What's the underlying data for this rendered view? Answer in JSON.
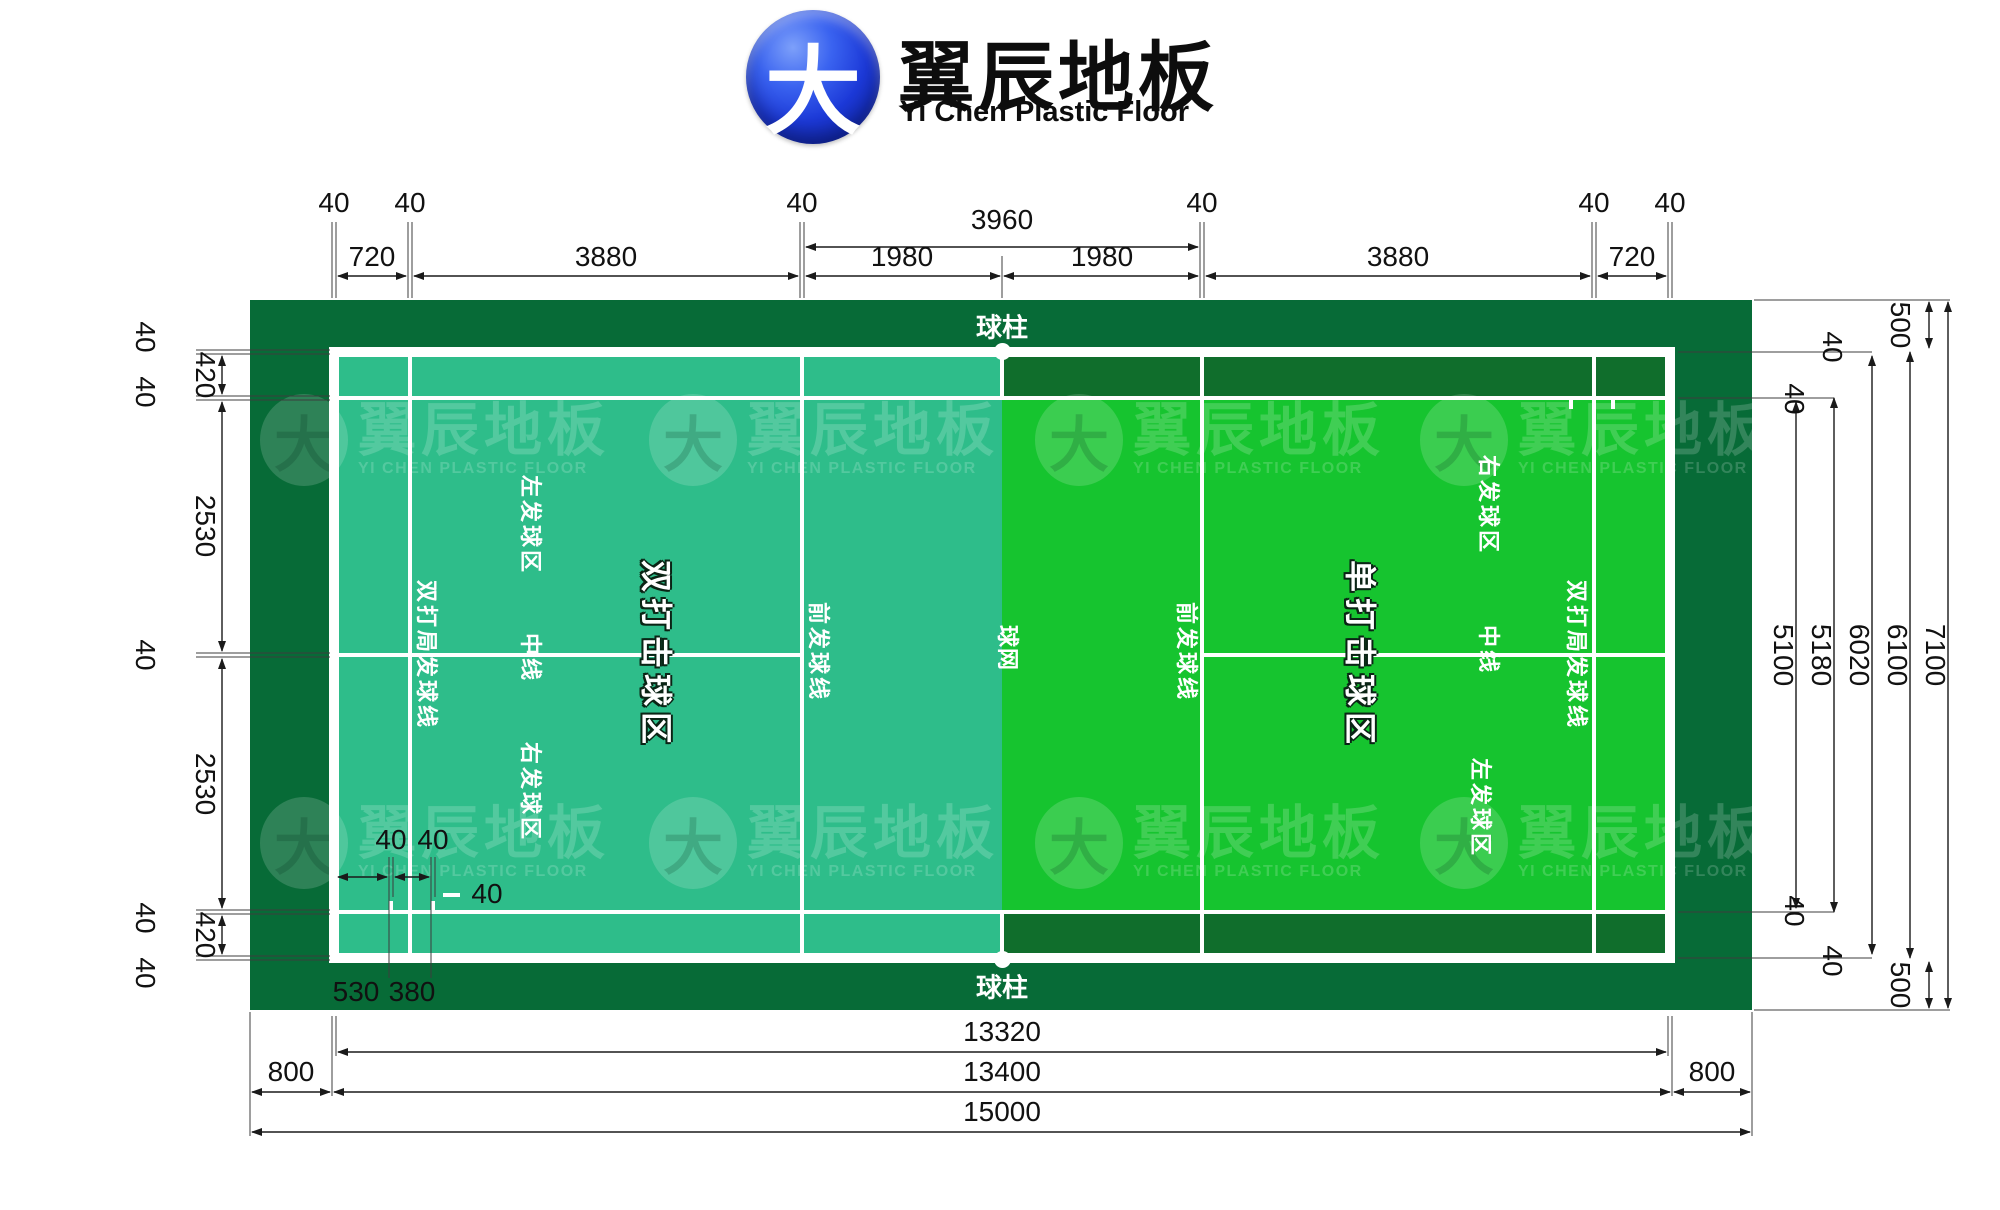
{
  "brand": {
    "glyph": "大",
    "name_cn": "翼辰地板",
    "name_en": "Yi Chen Plastic Floor",
    "watermark_cn": "翼辰地板",
    "watermark_en": "YI CHEN PLASTIC FLOOR"
  },
  "court": {
    "post_top": "球柱",
    "post_bottom": "球柱",
    "net": "球网",
    "doubles_zone": "双打击球区",
    "singles_zone": "单打击球区",
    "left": {
      "long_service_line": "双打局发球线",
      "left_service": "左发球区",
      "center_line": "中线",
      "right_service": "右发球区",
      "front_service_line": "前发球线"
    },
    "right": {
      "front_service_line": "前发球线",
      "right_service": "右发球区",
      "center_line": "中线",
      "left_service": "左发球区",
      "long_service_line": "双打局发球线"
    }
  },
  "dims": {
    "top_forties": [
      "40",
      "40",
      "40",
      "40",
      "40",
      "40"
    ],
    "top_span": "3960",
    "top_segments": [
      "720",
      "3880",
      "1980",
      "1980",
      "3880",
      "720"
    ],
    "left_forties": [
      "40",
      "40",
      "40",
      "40",
      "40"
    ],
    "left_segments": [
      "420",
      "2530",
      "2530",
      "420"
    ],
    "right_verticals": [
      "5100",
      "5180",
      "6020",
      "6100",
      "7100"
    ],
    "right_margins": [
      "500",
      "500"
    ],
    "right_forties": [
      "40",
      "40",
      "40",
      "40"
    ],
    "bottom_totals": [
      "13320",
      "13400",
      "15000"
    ],
    "bottom_margins": [
      "800",
      "800"
    ],
    "tick_forties": [
      "40",
      "40"
    ],
    "tick_offsets": [
      "530",
      "380"
    ],
    "line_width_sample": "40"
  },
  "colors": {
    "surround_green": "#076B37",
    "alley_green": "#106E2C",
    "left_court_teal": "#2EBD8A",
    "right_court_green": "#16C42F",
    "line_white": "#FFFFFF",
    "logo_blue": "#1C39D8"
  }
}
